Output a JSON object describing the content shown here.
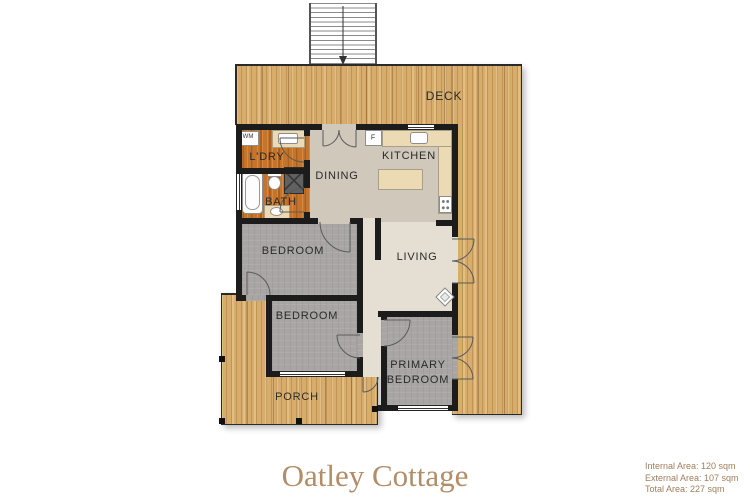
{
  "title": "Oatley Cottage",
  "area_summary": {
    "internal": "Internal Area: 120 sqm",
    "external": "External Area: 107 sqm",
    "total": "Total Area: 227 sqm"
  },
  "rooms": {
    "deck": {
      "label": "DECK"
    },
    "laundry": {
      "label": "L'DRY"
    },
    "bath": {
      "label": "BATH"
    },
    "dining": {
      "label": "DINING"
    },
    "kitchen": {
      "label": "KITCHEN"
    },
    "bedroom1": {
      "label": "BEDROOM"
    },
    "living": {
      "label": "LIVING"
    },
    "bedroom2": {
      "label": "BEDROOM"
    },
    "primary_bedroom": {
      "line1": "PRIMARY",
      "line2": "BEDROOM"
    },
    "porch": {
      "label": "PORCH"
    }
  },
  "fixtures": {
    "washing_machine": "WM",
    "fridge": "F"
  },
  "colors": {
    "deck_wood": "#d8ad6b",
    "warm_wood": "#c4742b",
    "carpet": "#a9a5a5",
    "greige": "#cfc8bb",
    "cream": "#e5dfd3",
    "wall": "#1c1c1c",
    "counter": "#ecdab4",
    "shower": "#616161",
    "label": "#2a2a2a",
    "outline": "#2a2a2a",
    "title": "#b28d67",
    "area_text": "#a17e5b"
  }
}
